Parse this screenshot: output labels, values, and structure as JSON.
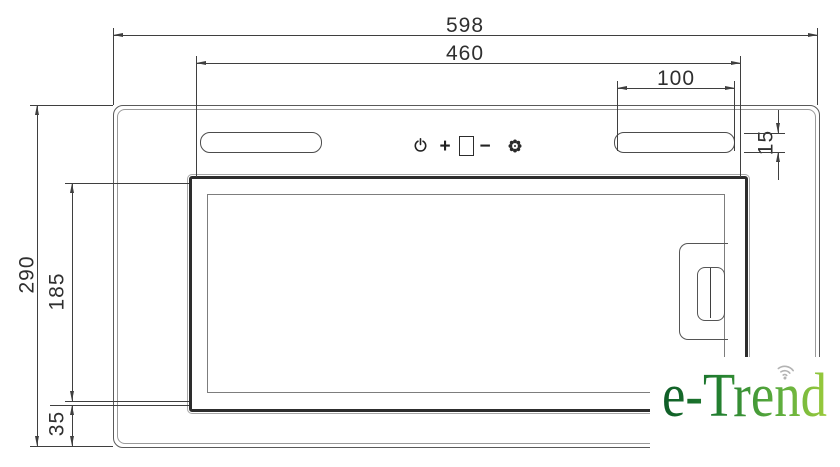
{
  "dims": {
    "total_width": "598",
    "panel_width": "460",
    "light_width": "100",
    "light_height": "15",
    "total_height": "290",
    "panel_height": "185",
    "bottom_height": "35"
  },
  "controls": {
    "plus": "+",
    "minus": "−"
  },
  "icons": {
    "power": "power-symbol",
    "display": "square-display-window",
    "light": "flower-light-symbol",
    "wifi": "wifi-arcs"
  },
  "logo": {
    "text": "e-Trend"
  },
  "colors": {
    "line": "#3f3f3f",
    "logo_green_dark": "#0e5c27",
    "logo_green_light": "#9aca3c",
    "wifi_gray": "#b3b3b3"
  }
}
